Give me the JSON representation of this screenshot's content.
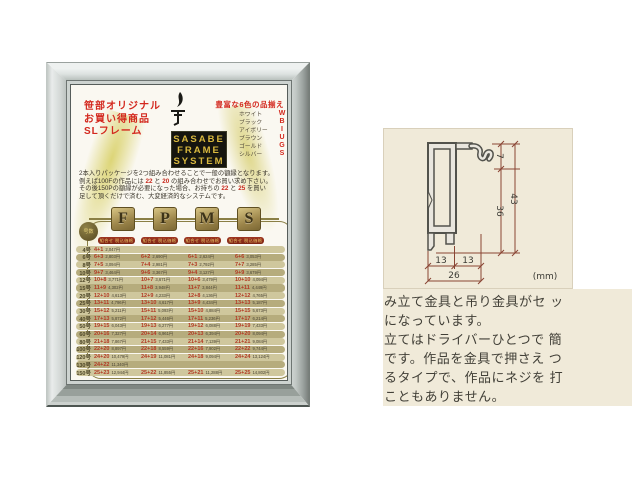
{
  "poster": {
    "promo_lines": [
      "笹部オリジナル",
      "お買い得商品",
      "SLフレーム"
    ],
    "logo_lines": [
      "SASABE",
      "FRAME",
      "SYSTEM"
    ],
    "colors_heading": "豊富な6色の品揃え",
    "color_names": [
      "ホワイト",
      "ブラック",
      "アイボリー",
      "ブラウン",
      "ゴールド",
      "シルバー"
    ],
    "color_codes": [
      "W",
      "B",
      "I",
      "U",
      "G",
      "S"
    ],
    "intro_lines": [
      [
        {
          "t": "2本入りパッケージを2つ組み合わせることで一般の額縁となります。"
        }
      ],
      [
        {
          "t": "例えば100Fの作品には "
        },
        {
          "t": "22",
          "red": true
        },
        {
          "t": " と "
        },
        {
          "t": "20",
          "red": true
        },
        {
          "t": " の組み合わせでお買い求め下さい。"
        }
      ],
      [
        {
          "t": "その後150Pの額縁が必要になった場合、お持ちの "
        },
        {
          "t": "22",
          "red": true
        },
        {
          "t": " と "
        },
        {
          "t": "25",
          "red": true
        },
        {
          "t": " を買い"
        }
      ],
      [
        {
          "t": "足して頂くだけで済む、大変経済的なシステムです。"
        }
      ]
    ],
    "series_letters": [
      "F",
      "P",
      "M",
      "S"
    ],
    "size_circle_label": "号数",
    "column_header": "組合せ 税込価格",
    "table_rows": [
      {
        "size": "4号",
        "cells": [
          {
            "combo": "4+1",
            "price": "2,047円"
          },
          null,
          null,
          null
        ]
      },
      {
        "size": "6号",
        "cells": [
          {
            "combo": "6+3",
            "price": "2,803円"
          },
          {
            "combo": "6+2",
            "price": "2,690円"
          },
          {
            "combo": "6+1",
            "price": "2,624円"
          },
          {
            "combo": "6+6",
            "price": "3,053円"
          }
        ]
      },
      {
        "size": "8号",
        "cells": [
          {
            "combo": "7+5",
            "price": "3,094円"
          },
          {
            "combo": "7+4",
            "price": "2,981円"
          },
          {
            "combo": "7+3",
            "price": "2,792円"
          },
          {
            "combo": "7+7",
            "price": "3,285円"
          }
        ]
      },
      {
        "size": "10号",
        "cells": [
          {
            "combo": "9+7",
            "price": "3,464円"
          },
          {
            "combo": "9+6",
            "price": "3,367円"
          },
          {
            "combo": "9+4",
            "price": "3,127円"
          },
          {
            "combo": "9+9",
            "price": "3,679円"
          }
        ]
      },
      {
        "size": "12号",
        "cells": [
          {
            "combo": "10+8",
            "price": "3,771円"
          },
          {
            "combo": "10+7",
            "price": "3,671円"
          },
          {
            "combo": "10+6",
            "price": "3,479円"
          },
          {
            "combo": "10+10",
            "price": "4,094円"
          }
        ]
      },
      {
        "size": "15号",
        "cells": [
          {
            "combo": "11+9",
            "price": "4,302円"
          },
          {
            "combo": "11+8",
            "price": "3,948円"
          },
          {
            "combo": "11+7",
            "price": "3,844円"
          },
          {
            "combo": "11+11",
            "price": "4,449円"
          }
        ]
      },
      {
        "size": "20号",
        "cells": [
          {
            "combo": "12+10",
            "price": "4,613円"
          },
          {
            "combo": "12+9",
            "price": "4,233円"
          },
          {
            "combo": "12+8",
            "price": "4,136円"
          },
          {
            "combo": "12+12",
            "price": "4,765円"
          }
        ]
      },
      {
        "size": "25号",
        "cells": [
          {
            "combo": "13+11",
            "price": "4,796円"
          },
          {
            "combo": "13+10",
            "price": "4,617円"
          },
          {
            "combo": "13+9",
            "price": "4,434円"
          },
          {
            "combo": "13+13",
            "price": "5,187円"
          }
        ]
      },
      {
        "size": "30号",
        "cells": [
          {
            "combo": "15+12",
            "price": "5,211円"
          },
          {
            "combo": "15+11",
            "price": "5,093円"
          },
          {
            "combo": "15+10",
            "price": "4,884円"
          },
          {
            "combo": "15+15",
            "price": "5,673円"
          }
        ]
      },
      {
        "size": "40号",
        "cells": [
          {
            "combo": "17+13",
            "price": "5,872円"
          },
          {
            "combo": "17+12",
            "price": "5,446円"
          },
          {
            "combo": "17+11",
            "price": "5,236円"
          },
          {
            "combo": "17+17",
            "price": "6,214円"
          }
        ]
      },
      {
        "size": "50号",
        "cells": [
          {
            "combo": "19+15",
            "price": "6,043円"
          },
          {
            "combo": "19+13",
            "price": "6,277円"
          },
          {
            "combo": "19+12",
            "price": "6,088円"
          },
          {
            "combo": "19+19",
            "price": "7,433円"
          }
        ]
      },
      {
        "size": "60号",
        "cells": [
          {
            "combo": "20+16",
            "price": "7,327円"
          },
          {
            "combo": "20+14",
            "price": "6,961円"
          },
          {
            "combo": "20+13",
            "price": "6,394円"
          },
          {
            "combo": "20+20",
            "price": "8,094円"
          }
        ]
      },
      {
        "size": "80号",
        "cells": [
          {
            "combo": "21+18",
            "price": "7,867円"
          },
          {
            "combo": "21+15",
            "price": "7,433円"
          },
          {
            "combo": "21+14",
            "price": "7,139円"
          },
          {
            "combo": "21+21",
            "price": "9,084円"
          }
        ]
      },
      {
        "size": "100号",
        "cells": [
          {
            "combo": "22+20",
            "price": "8,897円"
          },
          {
            "combo": "22+18",
            "price": "8,559円"
          },
          {
            "combo": "22+16",
            "price": "7,902円"
          },
          {
            "combo": "22+22",
            "price": "9,744円"
          }
        ]
      },
      {
        "size": "120号",
        "cells": [
          {
            "combo": "24+20",
            "price": "10,479円"
          },
          {
            "combo": "24+19",
            "price": "11,081円"
          },
          {
            "combo": "24+18",
            "price": "9,094円"
          },
          {
            "combo": "24+24",
            "price": "13,124円"
          }
        ]
      },
      {
        "size": "130号",
        "cells": [
          {
            "combo": "24+22",
            "price": "11,340円"
          },
          null,
          null,
          null
        ]
      },
      {
        "size": "150号",
        "cells": [
          {
            "combo": "25+23",
            "price": "12,944円"
          },
          {
            "combo": "25+22",
            "price": "11,855円"
          },
          {
            "combo": "25+21",
            "price": "11,288円"
          },
          {
            "combo": "25+25",
            "price": "14,802円"
          }
        ]
      }
    ]
  },
  "diagram": {
    "d7": "7",
    "d36": "36",
    "d43": "43",
    "d13_left": "13",
    "d13_right": "13",
    "d26": "26",
    "unit": "(mm)",
    "dim_color": "#8a4534"
  },
  "description": {
    "lines": [
      "み立て金具と吊り金具がセ ッ",
      "になっています。",
      "立てはドライバーひとつで 簡",
      "です。作品を金具で押さえ つ",
      "るタイプで、作品にネジを 打",
      "こともありません。"
    ]
  }
}
